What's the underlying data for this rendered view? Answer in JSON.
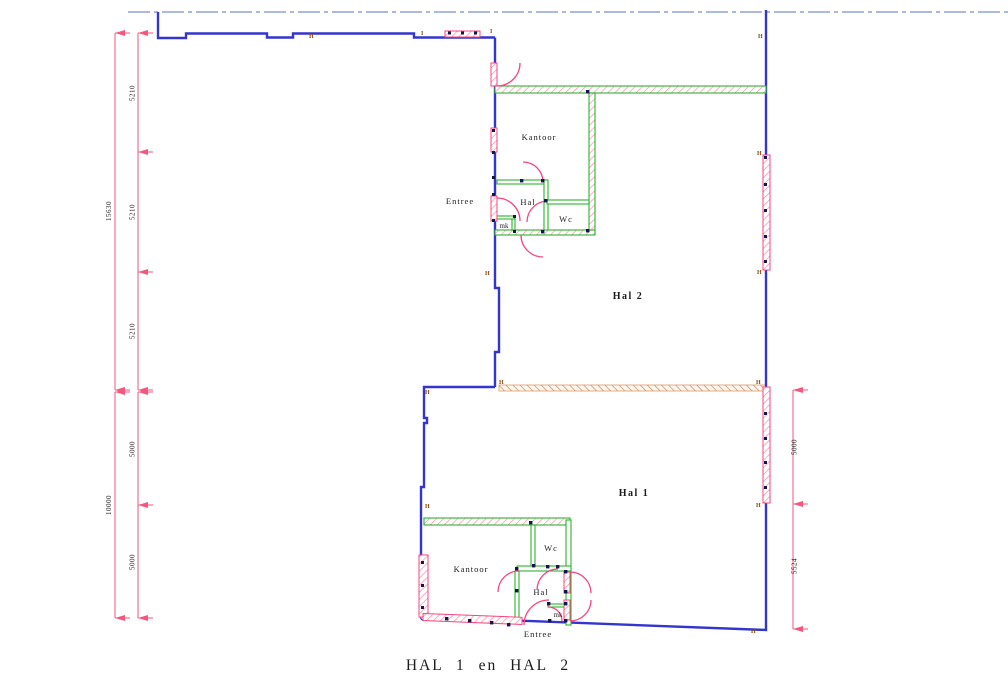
{
  "title": "HAL 1 en HAL 2",
  "halls": {
    "hal2": {
      "name": "Hal 2",
      "rooms": {
        "kantoor": "Kantoor",
        "entree": "Entree",
        "hal": "Hal",
        "wc": "Wc",
        "mk": "mk"
      }
    },
    "hal1": {
      "name": "Hal 1",
      "rooms": {
        "kantoor": "Kantoor",
        "entree": "Entree",
        "hal": "Hal",
        "wc": "Wc",
        "mk": "mk"
      }
    }
  },
  "dimensions": {
    "left_upper": {
      "total": "15630",
      "segments": [
        "5210",
        "5210",
        "5210"
      ]
    },
    "left_lower": {
      "total": "10000",
      "segments": [
        "5000",
        "5000"
      ]
    },
    "right": {
      "segments": [
        "5000",
        "5524"
      ]
    }
  },
  "grid_markers": {
    "h": "H",
    "i": "I"
  },
  "colors": {
    "wall_blue": "#3434cf",
    "partition_green": "#2db32d",
    "door_pink": "#f6457c",
    "dimension_pink": "#f6567c",
    "centerline_blue": "#8fa0d8",
    "separation_tan": "#d08a5a",
    "marker_brown": "#8a4a10"
  }
}
